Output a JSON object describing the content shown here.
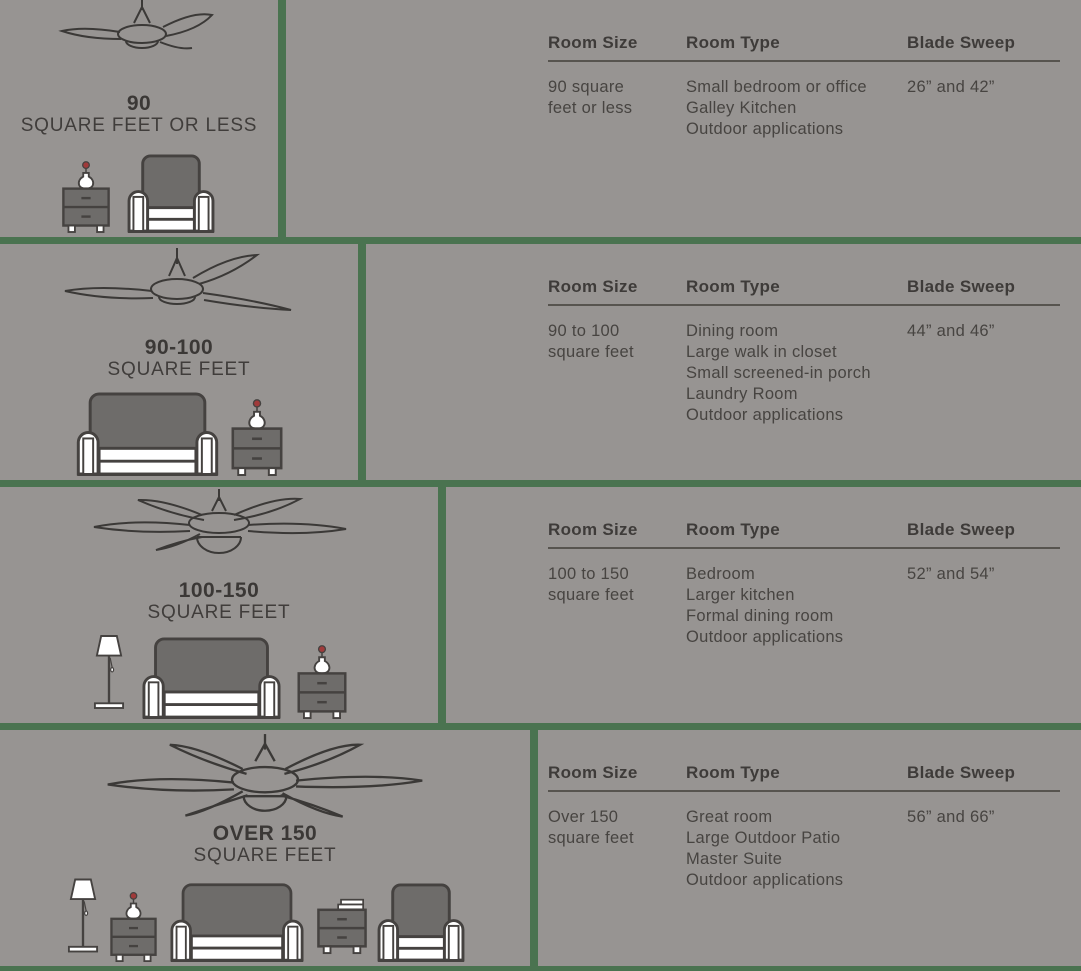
{
  "colors": {
    "background": "#979492",
    "divider_green": "#4a7350",
    "outline_dark": "#454240",
    "furniture_fill": "#6e6c6a",
    "body_text": "#474441",
    "heading_text": "#3e3b39",
    "flower_red": "#a03a3a"
  },
  "table_headers": [
    "Room Size",
    "Room Type",
    "Blade Sweep"
  ],
  "rows": [
    {
      "label_title": "90",
      "label_subtitle": "SQUARE FEET OR LESS",
      "fan_icon": "ceiling-fan-2-blade-icon",
      "room_size_lines": [
        "90 square",
        "feet or less"
      ],
      "room_types": [
        "Small bedroom or office",
        "Galley Kitchen",
        "Outdoor applications"
      ],
      "blade_sweep": "26” and 42”"
    },
    {
      "label_title": "90-100",
      "label_subtitle": "SQUARE FEET",
      "fan_icon": "ceiling-fan-3-blade-icon",
      "room_size_lines": [
        "90 to 100",
        "square feet"
      ],
      "room_types": [
        "Dining room",
        "Large walk in closet",
        "Small screened-in porch",
        "Laundry Room",
        "Outdoor applications"
      ],
      "blade_sweep": "44” and 46”"
    },
    {
      "label_title": "100-150",
      "label_subtitle": "SQUARE FEET",
      "fan_icon": "ceiling-fan-5-blade-light-icon",
      "room_size_lines": [
        "100 to 150",
        "square feet"
      ],
      "room_types": [
        "Bedroom",
        "Larger kitchen",
        "Formal dining room",
        "Outdoor applications"
      ],
      "blade_sweep": "52” and 54”"
    },
    {
      "label_title": "OVER 150",
      "label_subtitle": "SQUARE FEET",
      "fan_icon": "ceiling-fan-6-blade-light-icon",
      "room_size_lines": [
        "Over 150",
        "square feet"
      ],
      "room_types": [
        "Great room",
        "Large Outdoor Patio",
        "Master Suite",
        "Outdoor applications"
      ],
      "blade_sweep": "56” and 66”"
    }
  ]
}
